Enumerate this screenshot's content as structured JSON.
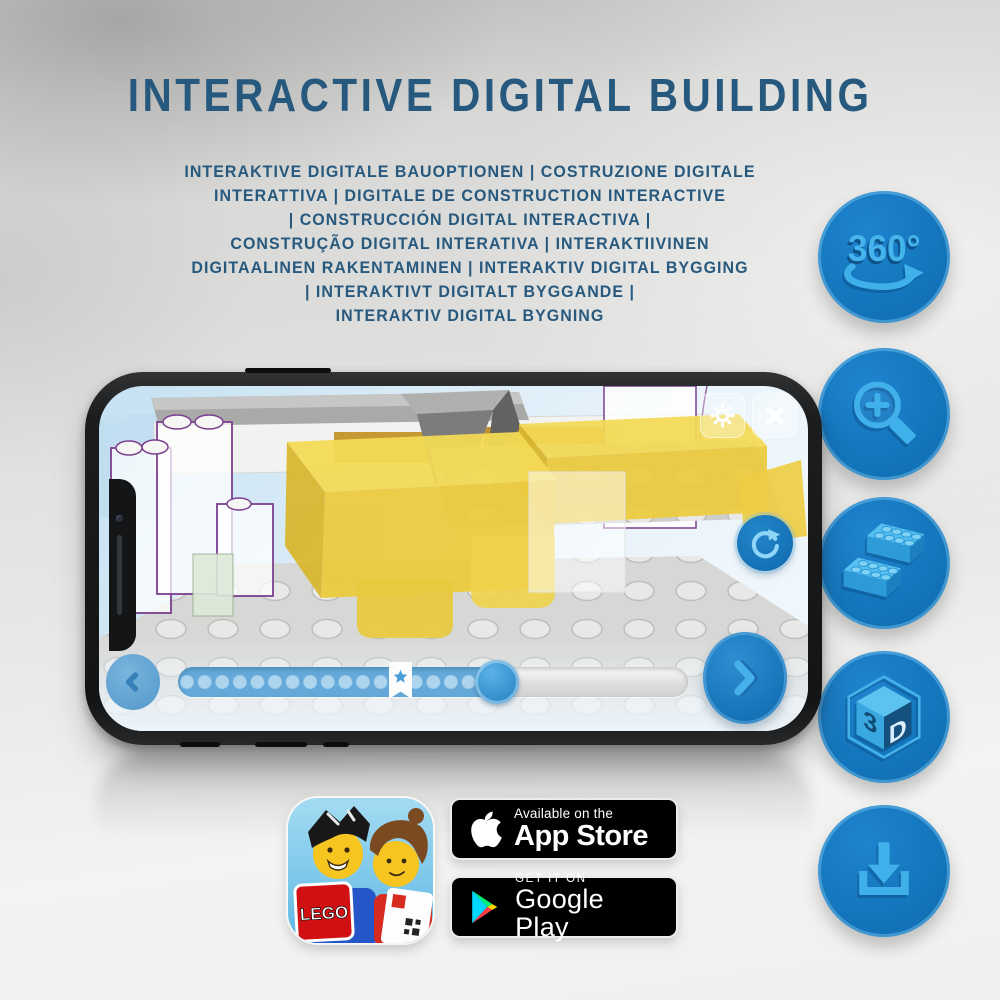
{
  "header": {
    "title": "INTERACTIVE DIGITAL BUILDING",
    "subtitle_lines": [
      "INTERAKTIVE DIGITALE BAUOPTIONEN | COSTRUZIONE DIGITALE",
      "INTERATTIVA | DIGITALE DE CONSTRUCTION INTERACTIVE",
      "| CONSTRUCCIÓN DIGITAL INTERACTIVA |",
      "CONSTRUÇÃO DIGITAL INTERATIVA | INTERAKTIIVINEN",
      "DIGITAALINEN RAKENTAMINEN | INTERAKTIV DIGITAL BYGGING",
      "| INTERAKTIVT DIGITALT BYGGANDE |",
      "INTERAKTIV DIGITAL BYGNING"
    ]
  },
  "features": [
    {
      "name": "360-rotation-icon",
      "label": "360°"
    },
    {
      "name": "zoom-in-icon"
    },
    {
      "name": "brick-icon"
    },
    {
      "name": "3d-cube-icon",
      "cube_left": "3",
      "cube_right": "D"
    },
    {
      "name": "download-icon"
    }
  ],
  "phone": {
    "progress_percent": 66
  },
  "badges": {
    "lego_app_logo_text": "LEGO",
    "app_store": {
      "tagline": "Available on the",
      "store": "App Store"
    },
    "google_play": {
      "tagline": "GET IT ON",
      "store": "Google Play"
    }
  },
  "colors": {
    "title_blue": "#27597f",
    "circle_blue": "#1172b8",
    "icon_light_blue": "#3fb0ea",
    "screen_blue": "#d9ebf7",
    "badge_black": "#000000"
  }
}
